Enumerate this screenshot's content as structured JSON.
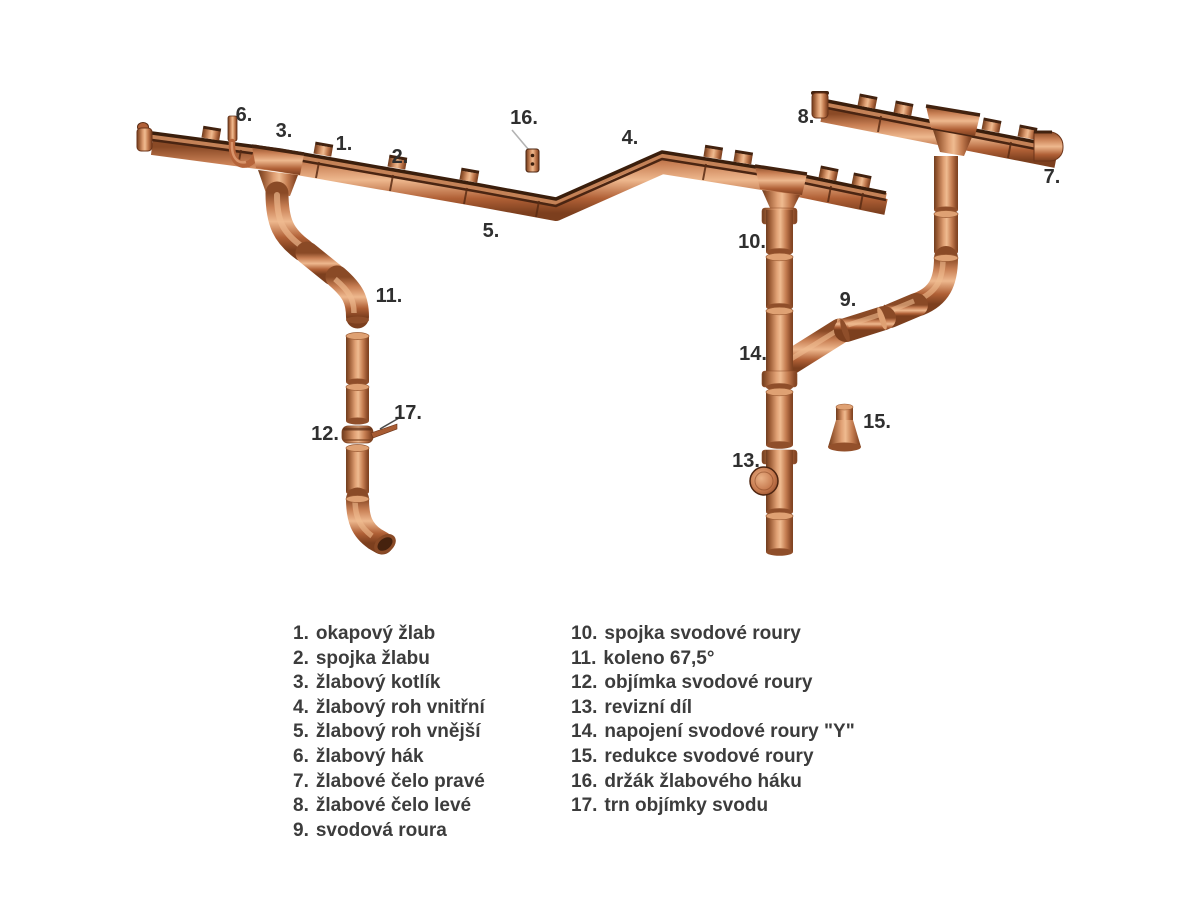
{
  "palette": {
    "copper_light": "#efbb90",
    "copper_mid": "#c47c50",
    "copper_dark": "#7c4220",
    "edge_dark": "#3a1e0c",
    "label_text": "#2f2f2f",
    "legend_text": "#3c3c3c",
    "leader_gray": "#b3b3b3",
    "background": "#ffffff"
  },
  "callouts": [
    "1.",
    "2.",
    "3.",
    "4.",
    "5.",
    "6.",
    "7.",
    "8.",
    "9.",
    "10.",
    "11.",
    "12.",
    "13.",
    "14.",
    "15.",
    "16.",
    "17."
  ],
  "legend": {
    "left": [
      {
        "num": "1.",
        "label": "okapový žlab"
      },
      {
        "num": "2.",
        "label": "spojka žlabu"
      },
      {
        "num": "3.",
        "label": "žlabový kotlík"
      },
      {
        "num": "4.",
        "label": "žlabový roh vnitřní"
      },
      {
        "num": "5.",
        "label": "žlabový roh vnější"
      },
      {
        "num": "6.",
        "label": "žlabový hák"
      },
      {
        "num": "7.",
        "label": "žlabové čelo pravé"
      },
      {
        "num": "8.",
        "label": "žlabové čelo levé"
      },
      {
        "num": "9.",
        "label": "svodová roura"
      }
    ],
    "right": [
      {
        "num": "10.",
        "label": "spojka svodové roury"
      },
      {
        "num": "11.",
        "label": "koleno 67,5°"
      },
      {
        "num": "12.",
        "label": "objímka svodové roury"
      },
      {
        "num": "13.",
        "label": "revizní díl"
      },
      {
        "num": "14.",
        "label": "napojení svodové roury \"Y\""
      },
      {
        "num": "15.",
        "label": "redukce svodové roury"
      },
      {
        "num": "16.",
        "label": "držák žlabového háku"
      },
      {
        "num": "17.",
        "label": "trn objímky svodu"
      }
    ]
  }
}
